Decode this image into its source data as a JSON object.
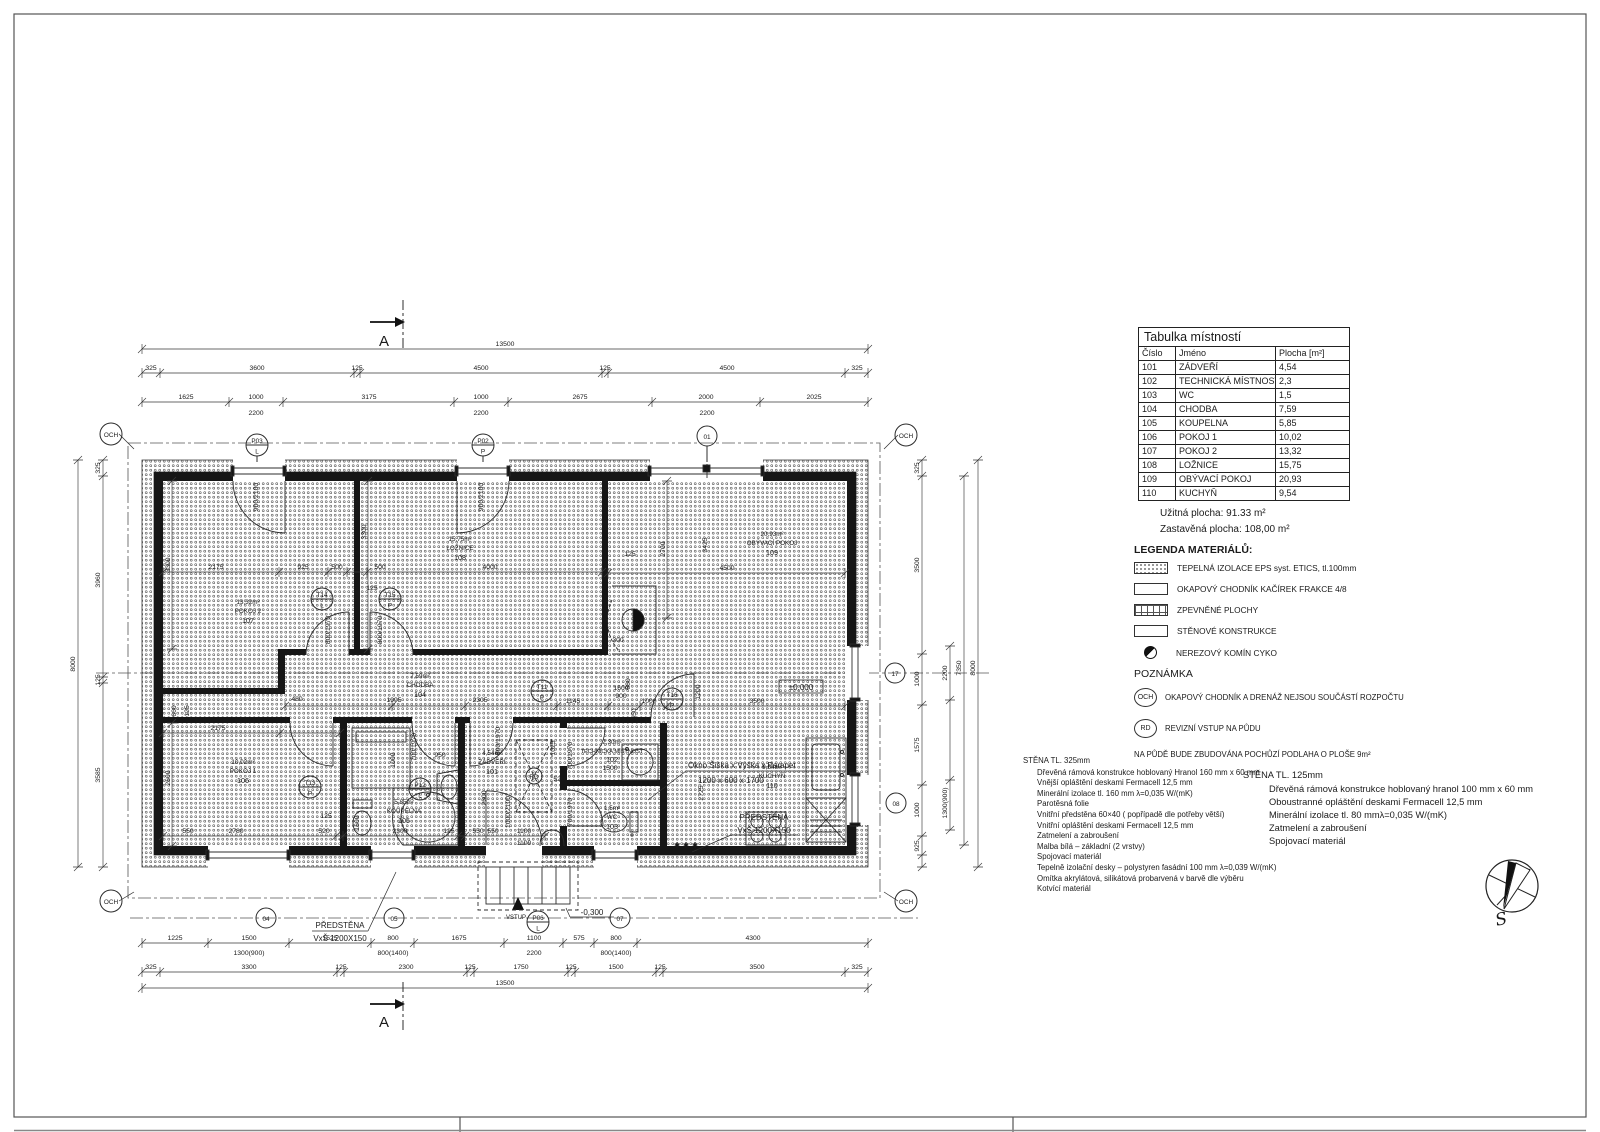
{
  "rooms_table": {
    "title": "Tabulka místností",
    "cols": [
      "Číslo",
      "Jméno",
      "Plocha [m²]"
    ],
    "rows": [
      [
        "101",
        "ZÁDVEŘÍ",
        "4,54"
      ],
      [
        "102",
        "TECHNICKÁ MÍSTNOST",
        "2,3"
      ],
      [
        "103",
        "WC",
        "1,5"
      ],
      [
        "104",
        "CHODBA",
        "7,59"
      ],
      [
        "105",
        "KOUPELNA",
        "5,85"
      ],
      [
        "106",
        "POKOJ 1",
        "10,02"
      ],
      [
        "107",
        "POKOJ 2",
        "13,32"
      ],
      [
        "108",
        "LOŽNICE",
        "15,75"
      ],
      [
        "109",
        "OBÝVACÍ POKOJ",
        "20,93"
      ],
      [
        "110",
        "KUCHYŇ",
        "9,54"
      ]
    ]
  },
  "areas": {
    "usable": "Užitná plocha:  91.33  m²",
    "built": "Zastavěná plocha: 108,00  m²"
  },
  "legend": {
    "heading": "LEGENDA MATERIÁLŮ:",
    "items": [
      "TEPELNÁ IZOLACE EPS syst. ETICS, tl.100mm",
      "OKAPOVÝ CHODNÍK KAČÍREK FRAKCE 4/8",
      "ZPEVNĚNÉ PLOCHY",
      "STĚNOVÉ KONSTRUKCE",
      "NEREZOVÝ KOMÍN CYKO"
    ]
  },
  "notes": {
    "heading": "POZNÁMKA",
    "och_label": "OCH",
    "och": "OKAPOVÝ CHODNÍK A DRENÁŽ NEJSOU SOUČÁSTÍ ROZPOČTU",
    "rd_label": "RD",
    "rd": "REVIZNÍ VSTUP NA PŮDU",
    "attic": "NA PŮDĚ BUDE ZBUDOVÁNA POCHŮZÍ PODLAHA O PLOŠE 9m²"
  },
  "wall325": {
    "heading": "STĚNA TL. 325mm",
    "lines": [
      "Dřevěná rámová konstrukce hoblovaný Hranol 160 mm x 60 mm",
      "Vnější opláštění deskami Fermacell 12,5 mm",
      "Minerální izolace tl. 160 mm λ=0,035 W/(mK)",
      "Parotěsná folie",
      "Vnitřní předstěna 60×40 ( popřípadě dle potřeby větší)",
      "Vnitřní opláštění deskami Fermacell 12,5 mm",
      "Zatmelení a zabroušení",
      "Malba bílá – základní (2 vrstvy)",
      "Spojovací materiál",
      "Tepelně izolační desky – polystyren fasádní 100 mm λ=0,039 W/(mK)",
      "Omítka akrylátová, silikátová probarvená v barvě dle výběru",
      "Kotvící materiál"
    ]
  },
  "wall125": {
    "heading": "STĚNA TL. 125mm",
    "lines": [
      "Dřevěná rámová konstrukce hoblovaný hranol 100 mm x 60 mm",
      "Oboustranné opláštění deskami Fermacell 12,5 mm",
      "Minerální izolace tl. 80 mmλ=0,035 W/(mK)",
      "Zatmelení a zabroušení",
      "Spojovací materiál"
    ]
  },
  "rooms": [
    {
      "a": "4,54m²",
      "n": "ZÁDVEŘÍ",
      "c": "101"
    },
    {
      "a": "2,30m²",
      "n": "TECHNICKÁ MÍSTNOST",
      "c": "102"
    },
    {
      "a": "1,5m²",
      "n": "WC",
      "c": "103"
    },
    {
      "a": "7,59m²",
      "n": "CHODBA",
      "c": "104"
    },
    {
      "a": "5,85m²",
      "n": "KOUPELNA",
      "c": "105"
    },
    {
      "a": "10,02m²",
      "n": "POKOJ 1",
      "c": "106"
    },
    {
      "a": "13,32m²",
      "n": "POKOJ 2",
      "c": "107"
    },
    {
      "a": "15,75m²",
      "n": "LOŽNICE",
      "c": "108"
    },
    {
      "a": "20,93m²",
      "n": "OBÝVACÍ POKOJ",
      "c": "109"
    },
    {
      "a": "9,54m²",
      "n": "KUCHYŇ",
      "c": "110"
    }
  ],
  "markers": {
    "p03": [
      "P03",
      "L"
    ],
    "p02": [
      "P02",
      "P"
    ],
    "o01": "01",
    "t14": [
      "T14",
      "L"
    ],
    "t15": [
      "T15",
      "P"
    ],
    "t11": [
      "T11",
      "P"
    ],
    "t13": [
      "T13",
      "P"
    ],
    "p12": [
      "P12",
      "L"
    ],
    "t16": [
      "T16",
      "P"
    ],
    "rd": "RD",
    "m04": "04",
    "m05": "05",
    "p06": [
      "P06",
      "L"
    ],
    "m07": "07",
    "m17": "17",
    "m08": "08",
    "och": "OCH"
  },
  "annotations": {
    "okno_l1": "Okno Šiška x Výška x Parapet",
    "okno_l2": "1200 x 600 x 1700",
    "predstena_l1": "PŘEDSTĚNA",
    "predstena_l2": "VxŠ 1200X150",
    "vstup": "VSTUP",
    "lvl0": "±0,000",
    "lvlm": "-0,300",
    "stars": "✱ ✱ ✱",
    "section": "A"
  },
  "compass": {
    "s": "S"
  },
  "dims": {
    "top": {
      "overall": "13500",
      "r2": [
        "325",
        "3600",
        "125",
        "4500",
        "125",
        "4500",
        "325"
      ],
      "r3": [
        "1625",
        "1000",
        "3175",
        "1000",
        "2675",
        "2000",
        "2025"
      ],
      "win": [
        "2200",
        "2200",
        "2200"
      ]
    },
    "bottom": {
      "r1": [
        "1225",
        "1500",
        "1525",
        "800",
        "1675",
        "1100",
        "575",
        "800",
        "4300"
      ],
      "r1b": [
        "1300(900)",
        "800(1400)",
        "2200",
        "800(1400)"
      ],
      "r2": [
        "325",
        "3300",
        "125",
        "2300",
        "125",
        "1750",
        "125",
        "1500",
        "125",
        "3500",
        "325"
      ],
      "overall": "13500"
    },
    "left": [
      "8000",
      "325",
      "3960",
      "125",
      "3585"
    ],
    "right": [
      "325",
      "3500",
      "1000",
      "1575",
      "1000",
      "925",
      "2200",
      "1300(900)",
      "7350",
      "8000"
    ],
    "inner": {
      "p107": [
        "3300",
        "2175",
        "925",
        "500"
      ],
      "p108": [
        "500",
        "4000",
        "3300",
        "125"
      ],
      "p109": [
        "2700",
        "3425",
        "4500",
        "125",
        "300",
        "3500",
        "1200"
      ],
      "chodba": [
        "480",
        "1995",
        "2305",
        "1145",
        "1600",
        "900",
        "1000",
        "550",
        "680"
      ],
      "p106": [
        "660",
        "125",
        "2175",
        "2600",
        "2780",
        "520",
        "125",
        "1100",
        "550"
      ],
      "koupelna": [
        "700/1970",
        "1000",
        "950",
        "1600",
        "2300",
        "125",
        "550"
      ],
      "zadveri": [
        "2600",
        "550",
        "520",
        "800/1970",
        "1000/2100",
        "1100"
      ],
      "tech": [
        "1500",
        "700/1970",
        "1025"
      ],
      "wc": [
        "700/1970"
      ],
      "kuchyn": [
        "2725"
      ],
      "doors": [
        "900/2100",
        "900/2100",
        "800/1970",
        "800/1970"
      ]
    }
  }
}
